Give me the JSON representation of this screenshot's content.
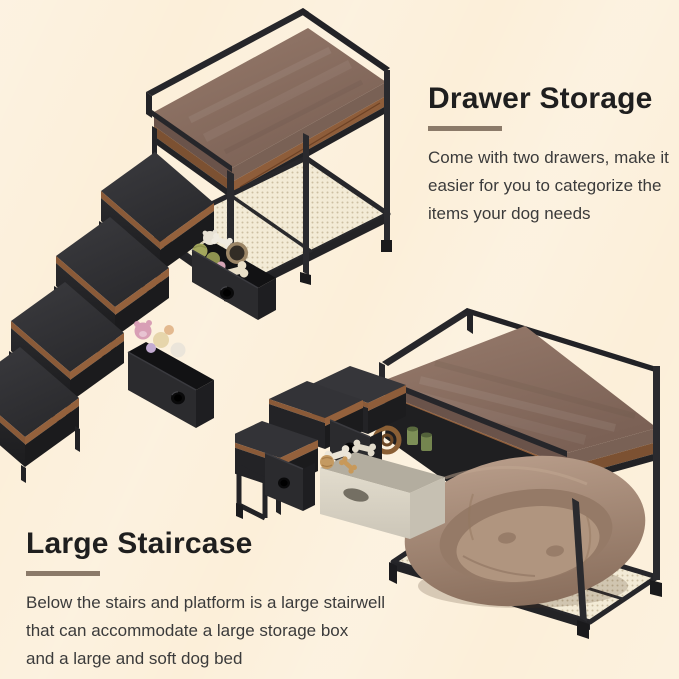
{
  "page": {
    "width_px": 679,
    "height_px": 679,
    "background_color": "#fcefd9"
  },
  "sections": {
    "drawer_storage": {
      "heading": "Drawer Storage",
      "description_lines": [
        "Come with two drawers, make it",
        "easier for you to categorize the",
        "items your dog needs"
      ]
    },
    "large_staircase": {
      "heading": "Large Staircase",
      "description_lines": [
        "Below the stairs and platform is a large stairwell",
        "that can accommodate a large storage box",
        "and a large and soft dog bed"
      ]
    }
  },
  "palette": {
    "heading_text": "#1f1f1f",
    "body_text": "#3b3b3b",
    "heading_underline": "#8b7a69",
    "metal_frame": "#26262a",
    "cushion_brown": "#84695c",
    "wood_trim": "#8e5d3a",
    "step_carpet": "#2f2f33",
    "drawer_fabric": "#2b2b2e",
    "mesh_cream": "#f3ebd6",
    "dog_bed_taupe": "#a48a77",
    "storage_box_cream": "#dad4c6",
    "toy_green": "#a3a75d",
    "toy_pink": "#d89fb5",
    "toy_bone_cream": "#e9dfc8"
  }
}
